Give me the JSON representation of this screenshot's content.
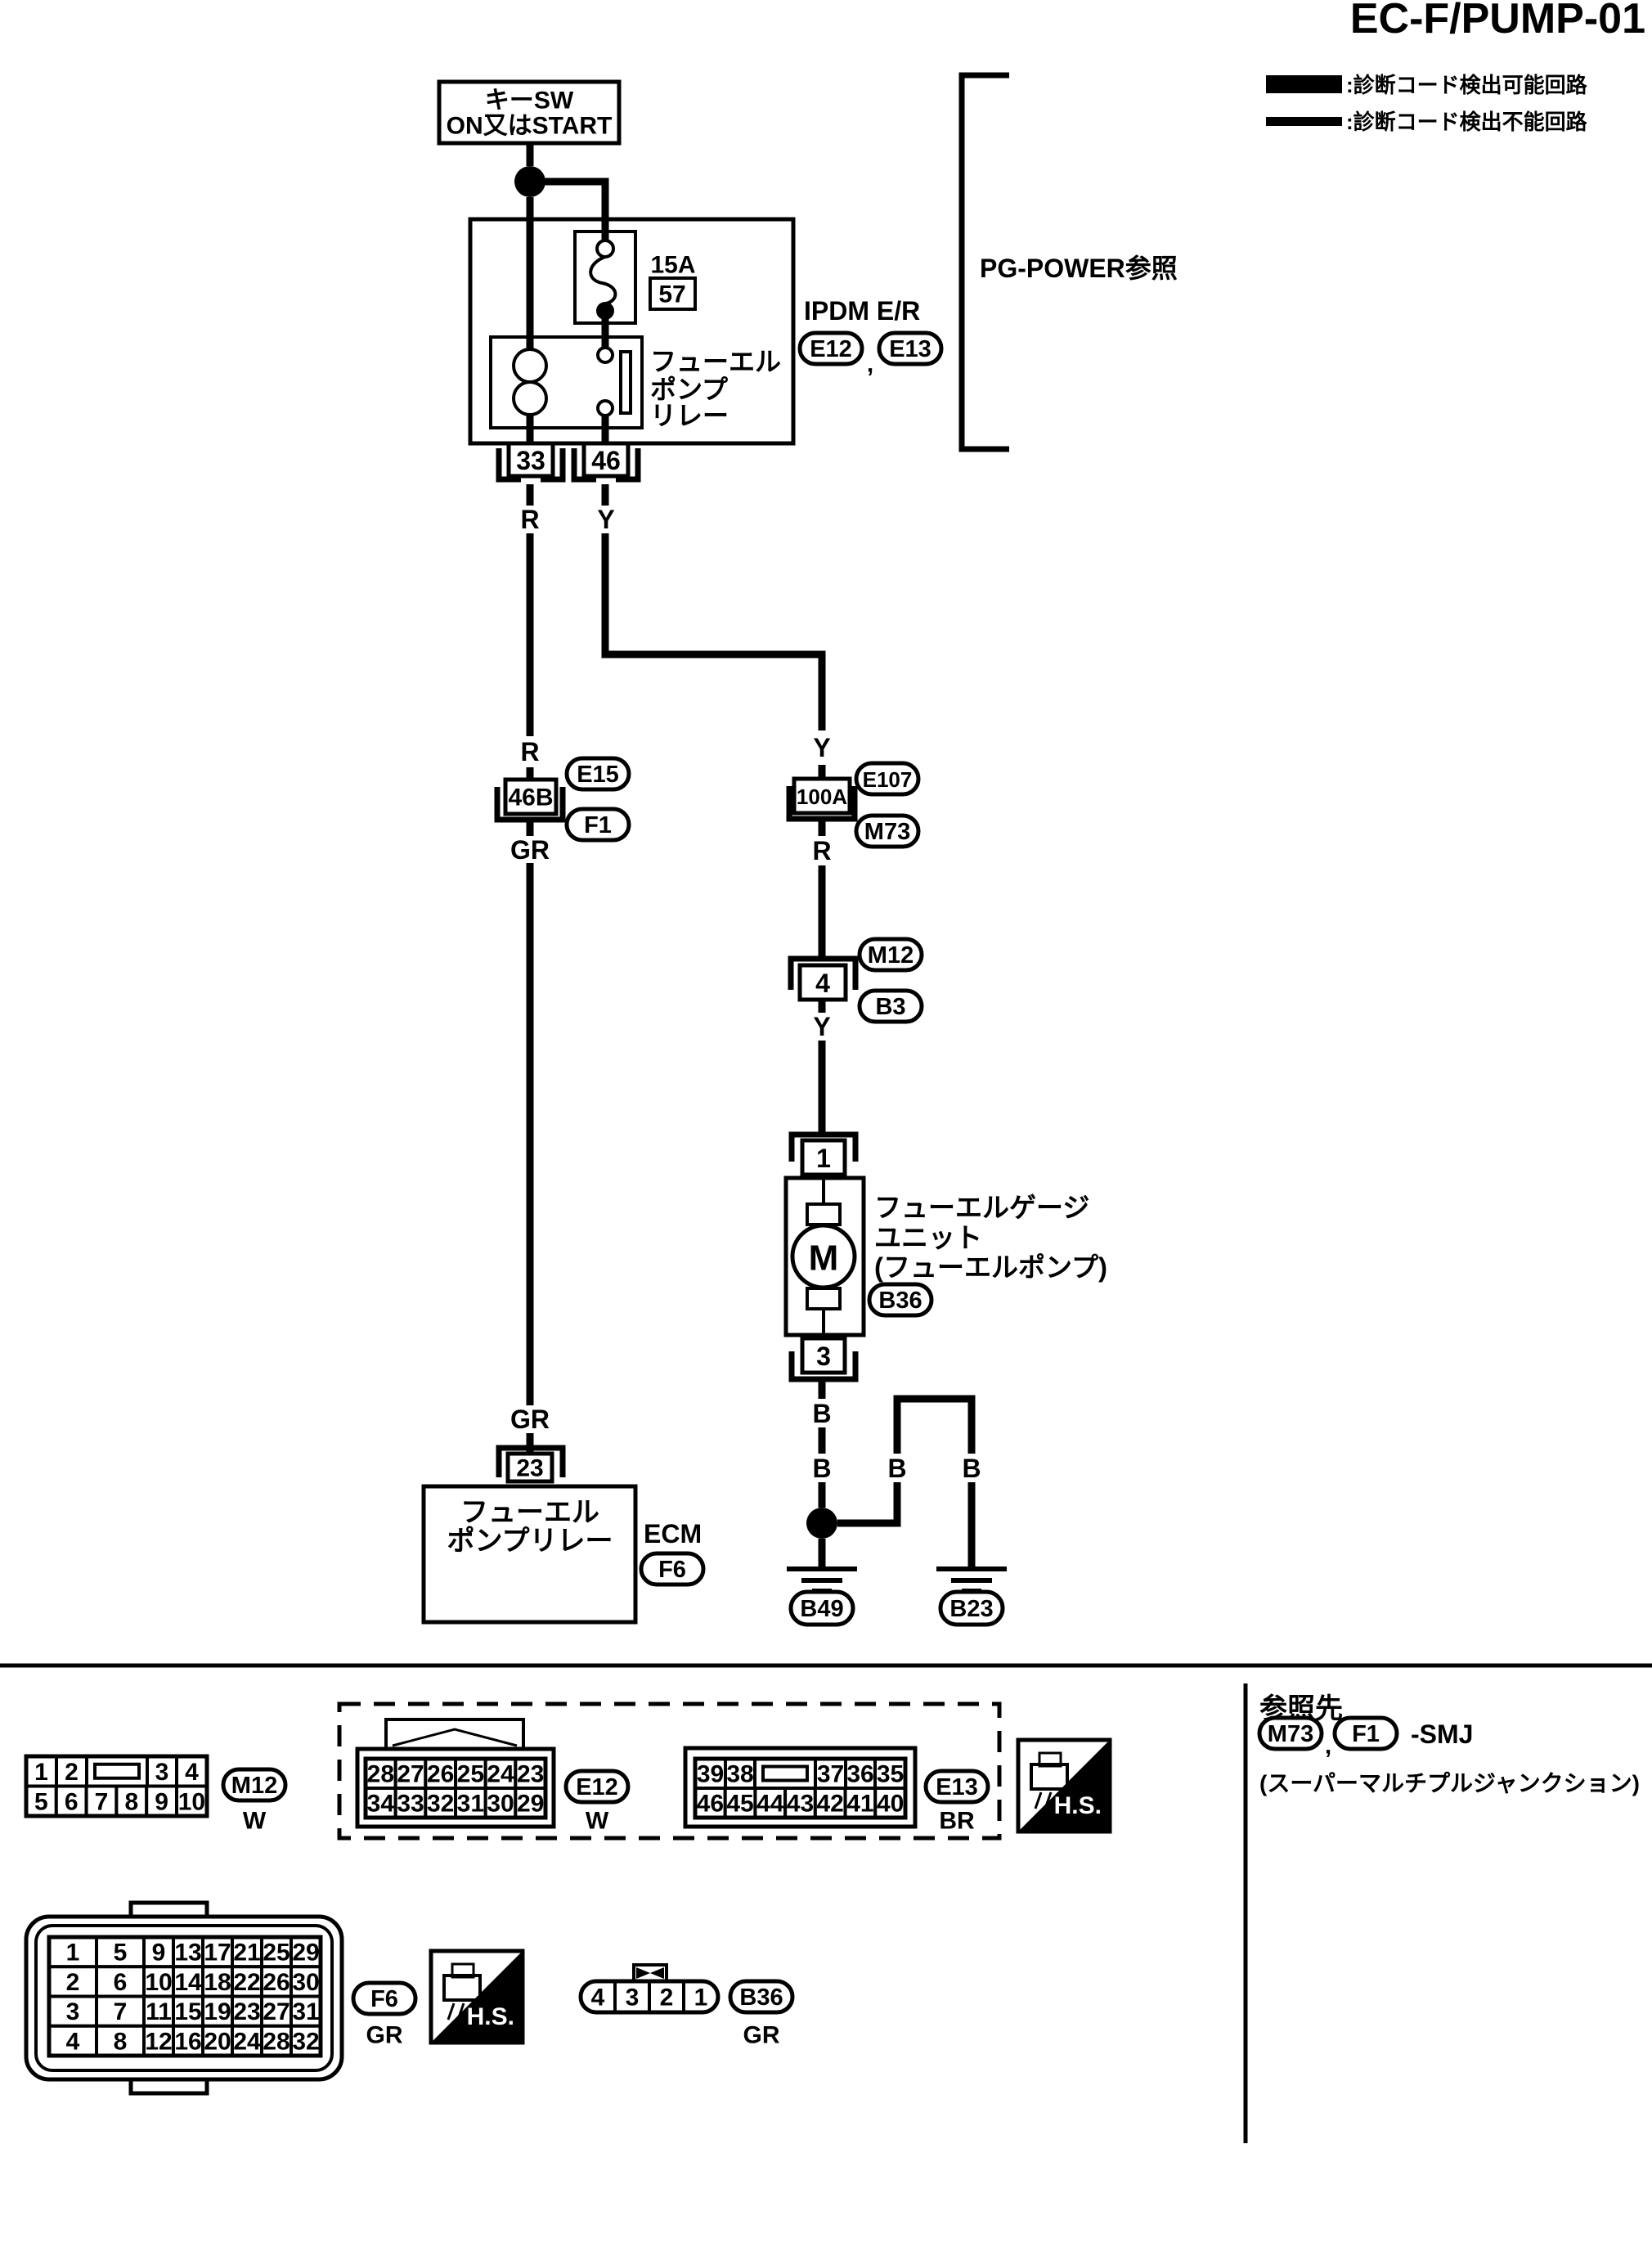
{
  "title": "EC-F/PUMP-01",
  "legend": {
    "detectable": ":診断コード検出可能回路",
    "undetectable": ":診断コード検出不能回路"
  },
  "top": {
    "key_switch_line1": "キーSW",
    "key_switch_line2": "ON又はSTART",
    "pg_power_note": "PG-POWER参照",
    "ipdm_label": "IPDM E/R",
    "ipdm_conn_a": "E12",
    "ipdm_comma": ",",
    "ipdm_conn_b": "E13",
    "fuse_rating": "15A",
    "fuse_number": "57",
    "relay_line1": "フューエル",
    "relay_line2": "ポンプ",
    "relay_line3": "リレー",
    "pin33": "33",
    "pin46": "46"
  },
  "wires": {
    "r1": "R",
    "y1": "Y",
    "r2": "R",
    "y2": "Y",
    "gr1": "GR",
    "r3": "R",
    "y3": "Y",
    "gr2": "GR",
    "b1": "B",
    "b2": "B",
    "b3": "B",
    "b4": "B"
  },
  "left": {
    "smj_pin": "46B",
    "conn_above": "E15",
    "conn_below": "F1",
    "ecm_pin": "23",
    "ecm_line1": "フューエル",
    "ecm_line2": "ポンプリレー",
    "ecm_label": "ECM",
    "ecm_conn": "F6"
  },
  "right": {
    "smj_pin": "100A",
    "conn_above": "E107",
    "conn_below": "M73",
    "m12_pin": "4",
    "m12_above": "M12",
    "m12_below": "B3",
    "fg_pin_in": "1",
    "fg_pin_out": "3",
    "motor": "M",
    "fg_line1": "フューエルゲージ",
    "fg_line2": "ユニット",
    "fg_line3": "(フューエルポンプ)",
    "fg_conn": "B36",
    "ground_left": "B49",
    "ground_right": "B23"
  },
  "footer": {
    "m12_view": {
      "id": "M12",
      "color": "W",
      "rows": [
        [
          "1",
          "2",
          "",
          "3",
          "4"
        ],
        [
          "5",
          "6",
          "7",
          "8",
          "9",
          "10"
        ]
      ]
    },
    "e12_view": {
      "id": "E12",
      "color": "W",
      "rows": [
        [
          "28",
          "27",
          "26",
          "25",
          "24",
          "23"
        ],
        [
          "34",
          "33",
          "32",
          "31",
          "30",
          "29"
        ]
      ]
    },
    "e13_view": {
      "id": "E13",
      "color": "BR",
      "rows": [
        [
          "39",
          "38",
          "",
          "37",
          "36",
          "35"
        ],
        [
          "46",
          "45",
          "44",
          "43",
          "42",
          "41",
          "40"
        ]
      ]
    },
    "f6_view": {
      "id": "F6",
      "color": "GR",
      "rows": [
        [
          "1",
          "5",
          "9",
          "13",
          "17",
          "21",
          "25",
          "29"
        ],
        [
          "2",
          "6",
          "10",
          "14",
          "18",
          "22",
          "26",
          "30"
        ],
        [
          "3",
          "7",
          "11",
          "15",
          "19",
          "23",
          "27",
          "31"
        ],
        [
          "4",
          "8",
          "12",
          "16",
          "20",
          "24",
          "28",
          "32"
        ]
      ]
    },
    "b36_view": {
      "id": "B36",
      "color": "GR",
      "cells": [
        "4",
        "3",
        "2",
        "1"
      ]
    },
    "hs_label_1": "H.S.",
    "hs_label_2": "H.S.",
    "ref_heading": "参照先",
    "ref_conn1": "M73",
    "ref_comma": ",",
    "ref_conn2": "F1",
    "ref_suffix": "-SMJ",
    "ref_note": "(スーパーマルチプルジャンクション)"
  }
}
